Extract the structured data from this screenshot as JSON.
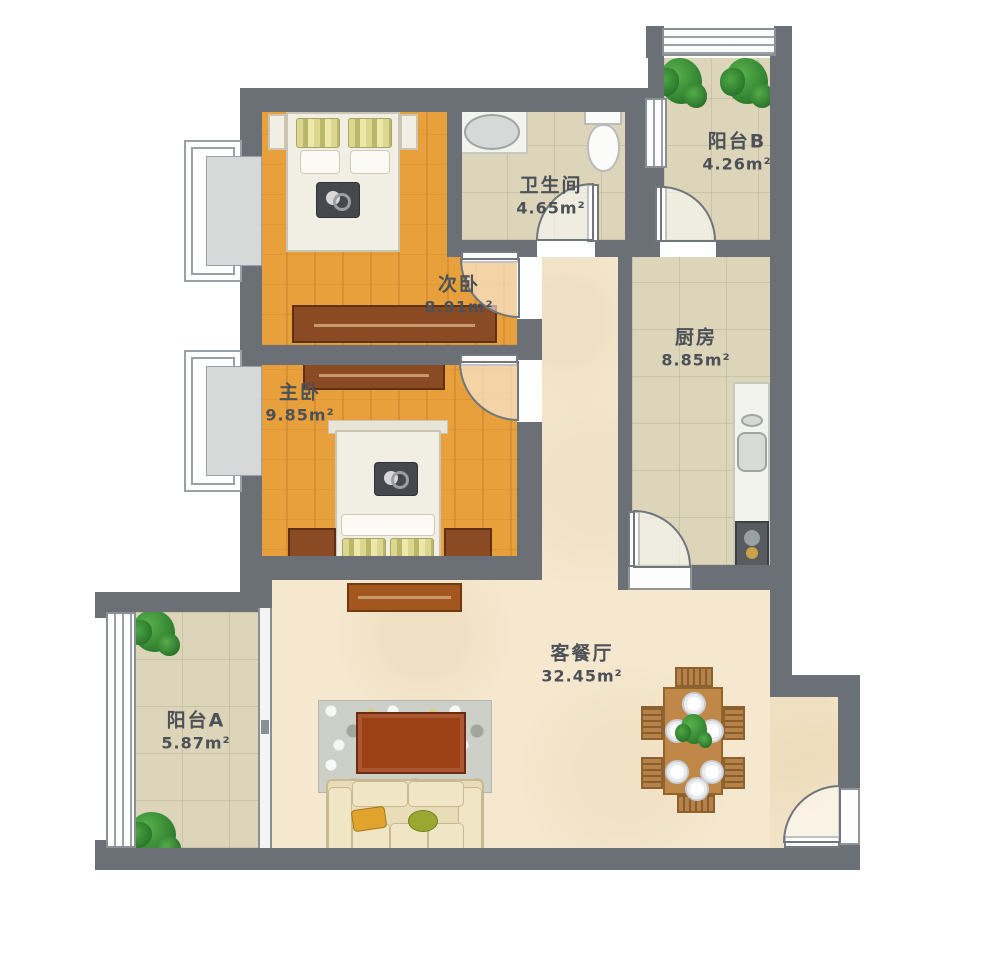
{
  "plan_type": "apartment-floor-plan",
  "rooms": [
    {
      "id": "secondary-bedroom",
      "name": "次卧",
      "area": "8.91m²"
    },
    {
      "id": "master-bedroom",
      "name": "主卧",
      "area": "9.85m²"
    },
    {
      "id": "bathroom",
      "name": "卫生间",
      "area": "4.65m²"
    },
    {
      "id": "balcony-b",
      "name": "阳台B",
      "area": "4.26m²"
    },
    {
      "id": "kitchen",
      "name": "厨房",
      "area": "8.85m²"
    },
    {
      "id": "living-dining",
      "name": "客餐厅",
      "area": "32.45m²"
    },
    {
      "id": "balcony-a",
      "name": "阳台A",
      "area": "5.87m²"
    }
  ],
  "fixtures": [
    "double-bed",
    "wardrobe",
    "nightstand-lamp",
    "bathroom-sink",
    "toilet",
    "kitchen-counter",
    "kitchen-sink",
    "gas-stove",
    "dining-table-six-seats",
    "sofa",
    "coffee-table",
    "tv-cabinet",
    "rug",
    "potted-plant",
    "bay-window",
    "sliding-door",
    "swing-door",
    "entry-door"
  ],
  "colors": {
    "wall": "#6b7076",
    "wood_floor": "#e7a03c",
    "tile_floor": "#dcd5ba",
    "living_floor": "#f5e8cf",
    "furniture_wood": "#8a4a24",
    "table_wood": "#bf8848",
    "plant_green": "#3d9b3d",
    "label_text": "#4c5157"
  }
}
